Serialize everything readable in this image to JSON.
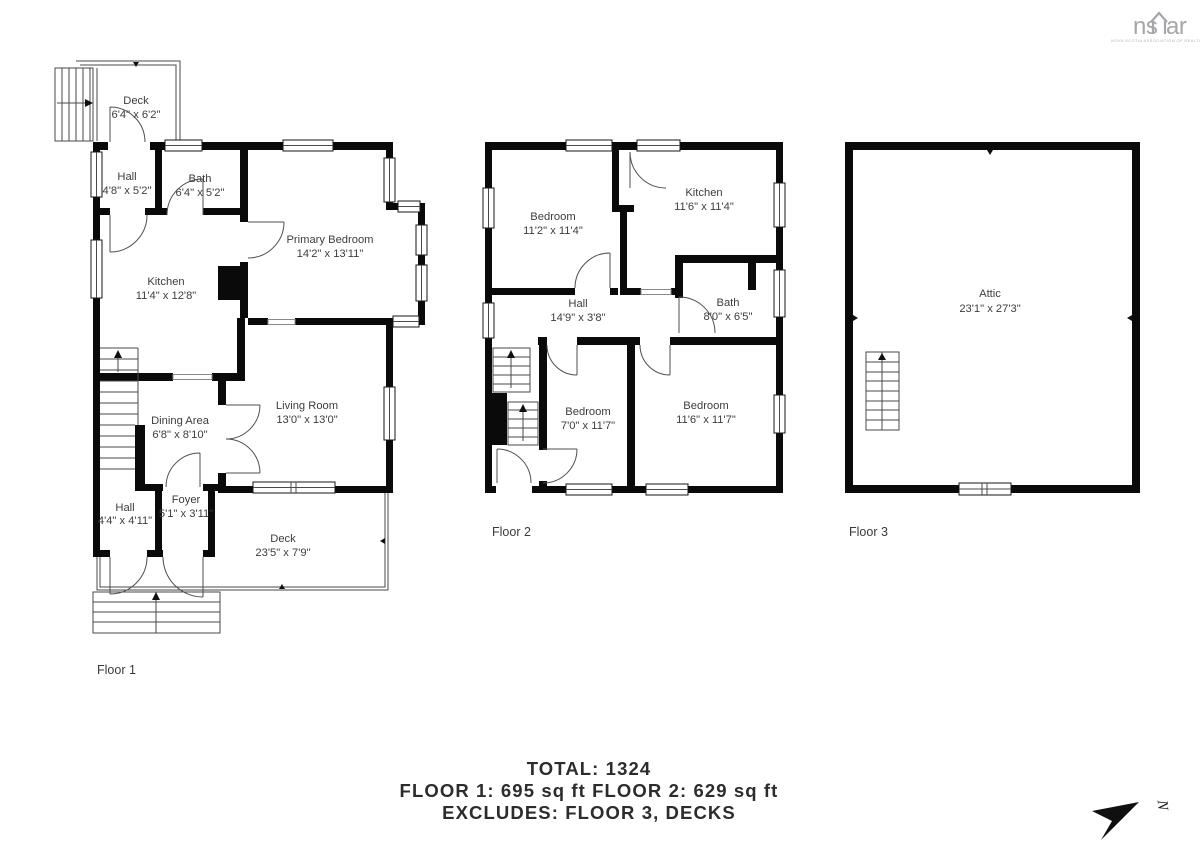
{
  "logo": {
    "left": "ns",
    "right": "ar",
    "caption": "NOVA SCOTIA ASSOCIATION OF REALTORS"
  },
  "floors": [
    {
      "label": "Floor 1",
      "rooms": [
        {
          "name": "Deck",
          "dims": "6'4\" x 6'2\""
        },
        {
          "name": "Hall",
          "dims": "4'8\" x 5'2\""
        },
        {
          "name": "Bath",
          "dims": "6'4\" x 5'2\""
        },
        {
          "name": "Kitchen",
          "dims": "11'4\" x 12'8\""
        },
        {
          "name": "Primary Bedroom",
          "dims": "14'2\" x 13'11\""
        },
        {
          "name": "Dining Area",
          "dims": "6'8\" x 8'10\""
        },
        {
          "name": "Living Room",
          "dims": "13'0\" x 13'0\""
        },
        {
          "name": "Hall",
          "dims": "4'4\" x 4'11\""
        },
        {
          "name": "Foyer",
          "dims": "5'1\" x 3'11\""
        },
        {
          "name": "Deck",
          "dims": "23'5\" x 7'9\""
        }
      ]
    },
    {
      "label": "Floor 2",
      "rooms": [
        {
          "name": "Bedroom",
          "dims": "11'2\" x 11'4\""
        },
        {
          "name": "Kitchen",
          "dims": "11'6\" x 11'4\""
        },
        {
          "name": "Hall",
          "dims": "14'9\" x 3'8\""
        },
        {
          "name": "Bath",
          "dims": "8'0\" x 6'5\""
        },
        {
          "name": "Bedroom",
          "dims": "7'0\" x 11'7\""
        },
        {
          "name": "Bedroom",
          "dims": "11'6\" x 11'7\""
        }
      ]
    },
    {
      "label": "Floor 3",
      "rooms": [
        {
          "name": "Attic",
          "dims": "23'1\" x 27'3\""
        }
      ]
    }
  ],
  "summary": {
    "line1": "TOTAL: 1324",
    "line2": "FLOOR 1: 695 sq ft FLOOR 2: 629 sq ft",
    "line3": "EXCLUDES: FLOOR 3, DECKS"
  },
  "compass": {
    "label": "N"
  }
}
